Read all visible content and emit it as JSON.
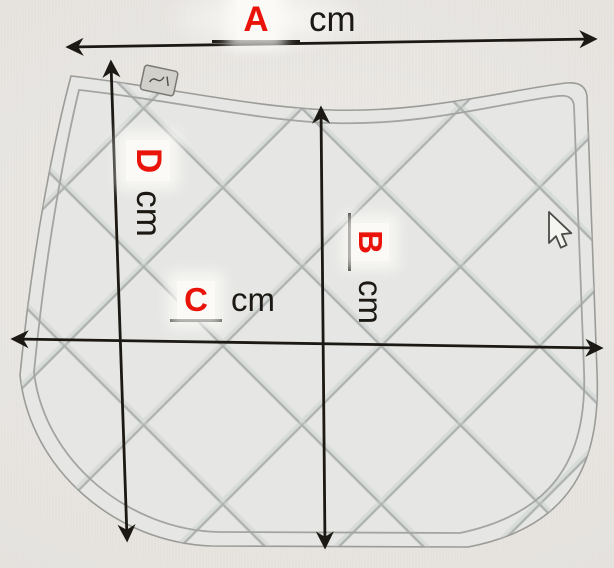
{
  "labels": {
    "a": {
      "letter": "A",
      "unit": "cm"
    },
    "b": {
      "letter": "B",
      "unit": "cm"
    },
    "c": {
      "letter": "C",
      "unit": "cm"
    },
    "d": {
      "letter": "D",
      "unit": "cm"
    }
  },
  "colors": {
    "label_letter_red": "#ea1309",
    "measurement_line_black": "#1c1914",
    "pad_fill": "#e6e7e4",
    "quilt_line": "#9aa09e",
    "background": "#e9e6e2"
  },
  "icons": {
    "cursor": "mouse-pointer-icon",
    "tag": "brand-tag-icon"
  }
}
